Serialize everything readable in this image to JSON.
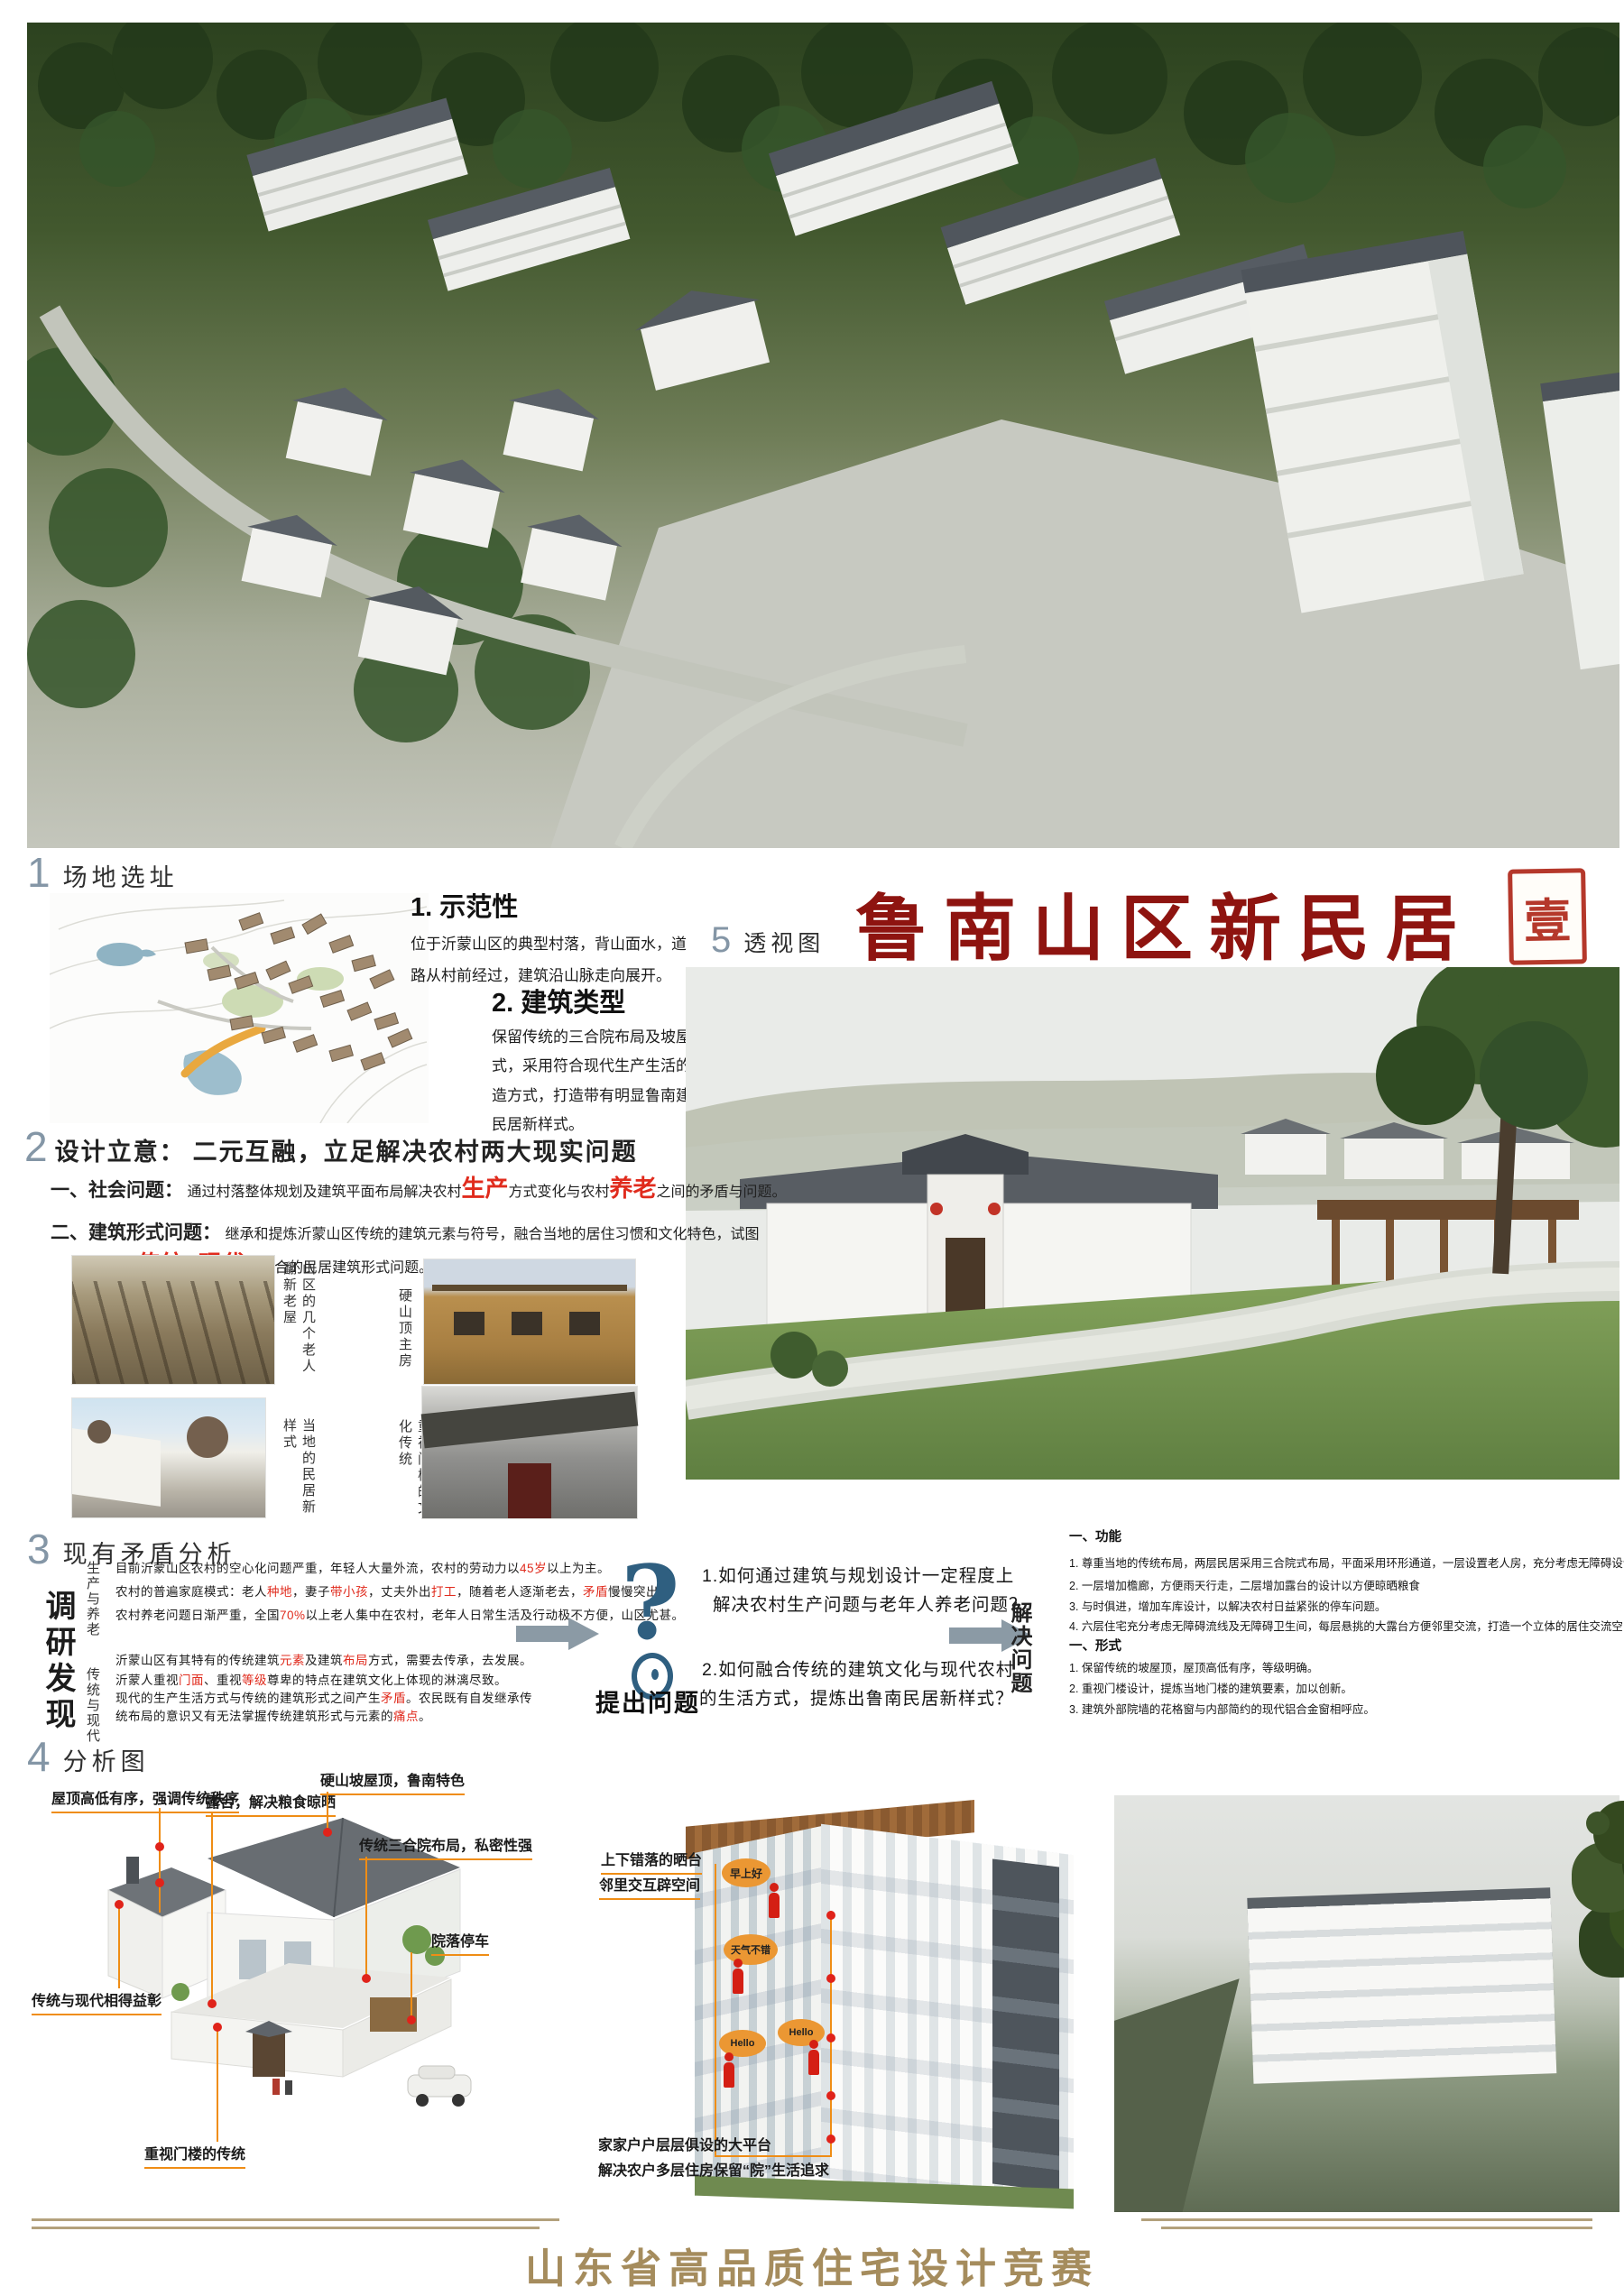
{
  "main_title": {
    "text": "鲁南山区新民居",
    "seal": "壹"
  },
  "footer": {
    "title": "山东省高品质住宅设计竞赛"
  },
  "section1": {
    "num": "1",
    "title": "场地选址",
    "demo": {
      "heading": "1. 示范性",
      "body": "位于沂蒙山区的典型村落，背山面水，道路从村前经过，建筑沿山脉走向展开。"
    },
    "type": {
      "heading": "2. 建筑类型",
      "body": "保留传统的三合院布局及坡屋顶的建筑形式，采用符合现代生产生活的平面及建筑构造方式，打造带有明显鲁南建筑风格特点的民居新样式。"
    }
  },
  "section5": {
    "num": "5",
    "title": "透视图"
  },
  "section2": {
    "num": "2",
    "lead": "设计立意：",
    "headline": "二元互融，立足解决农村两大现实问题",
    "item1_label": "一、社会问题：",
    "item1": [
      {
        "t": "通过村落整体规划及建筑平面布局解决农村"
      },
      {
        "t": "生产",
        "hl": true,
        "big": true
      },
      {
        "t": "方式变化与农村"
      },
      {
        "t": "养老",
        "hl": true,
        "big": true
      },
      {
        "t": "之间的矛盾与问题。"
      }
    ],
    "item2_label": "二、建筑形式问题：",
    "item2a": [
      {
        "t": "继承和提炼沂蒙山区传统的建筑元素与符号，融合当地的居住习惯和文化特色，试图"
      }
    ],
    "item2b": [
      {
        "t": "解决"
      },
      {
        "t": "传统",
        "hl": true,
        "big": true
      },
      {
        "t": "与"
      },
      {
        "t": "现代",
        "hl": true,
        "big": true
      },
      {
        "t": "相结合的民居建筑形式问题。"
      }
    ]
  },
  "photos": {
    "cap1": "山区的几个老人翻新老屋",
    "cap2": "当地的民居新样式",
    "cap3": "硬山顶主房",
    "cap4": "重视门楼的文化传统"
  },
  "section3": {
    "num": "3",
    "title": "现有矛盾分析",
    "survey_label": "调研发现",
    "g1_label": "生产与养老",
    "g1": [
      [
        {
          "t": "目前沂蒙山区农村的空心化问题严重，年轻人大量外流，农村的劳动力以"
        },
        {
          "t": "45岁",
          "hl": true
        },
        {
          "t": "以上为主。"
        }
      ],
      [
        {
          "t": "农村的普遍家庭模式：老人"
        },
        {
          "t": "种地",
          "hl": true
        },
        {
          "t": "，妻子"
        },
        {
          "t": "带小孩",
          "hl": true
        },
        {
          "t": "，丈夫外出"
        },
        {
          "t": "打工",
          "hl": true
        },
        {
          "t": "，随着老人逐渐老去，"
        },
        {
          "t": "矛盾",
          "hl": true
        },
        {
          "t": "慢慢突出。"
        }
      ],
      [
        {
          "t": "农村养老问题日渐严重，全国"
        },
        {
          "t": "70%",
          "hl": true
        },
        {
          "t": "以上老人集中在农村，老年人日常生活及行动极不方便，山区尤甚。"
        }
      ]
    ],
    "g2_label": "传统与现代",
    "g2": [
      [
        {
          "t": "沂蒙山区有其特有的传统建筑"
        },
        {
          "t": "元素",
          "hl": true
        },
        {
          "t": "及建筑"
        },
        {
          "t": "布局",
          "hl": true
        },
        {
          "t": "方式，需要去传承，去发展。"
        }
      ],
      [
        {
          "t": "沂蒙人重视"
        },
        {
          "t": "门面",
          "hl": true
        },
        {
          "t": "、重视"
        },
        {
          "t": "等级",
          "hl": true
        },
        {
          "t": "尊卑的特点在建筑文化上体现的淋漓尽致。"
        }
      ],
      [
        {
          "t": "现代的生产生活方式与传统的建筑形式之间产生"
        },
        {
          "t": "矛盾",
          "hl": true
        },
        {
          "t": "。农民既有自发继承传"
        }
      ],
      [
        {
          "t": "统布局的意识又有无法掌握传统建筑形式与元素的"
        },
        {
          "t": "痛点",
          "hl": true
        },
        {
          "t": "。"
        }
      ]
    ],
    "question_mark": "?",
    "ask_label": "提出问题",
    "q1a": "1.如何通过建筑与规划设计一定程度上",
    "q1b": "解决农村生产问题与老年人养老问题？",
    "q2a": "2.如何融合传统的建筑文化与现代农村",
    "q2b": "的生活方式，提炼出鲁南民居新样式？",
    "solve_label": "解决问题",
    "sol_g1_heading": "一、功能",
    "sol_g1": [
      "1. 尊重当地的传统布局，两层民居采用三合院式布局，平面采用环形通道，一层设置老人房，充分考虑无障碍设计。",
      "2. 一层增加檐廊，方便雨天行走，二层增加露台的设计以方便晾晒粮食",
      "3. 与时俱进，增加车库设计，以解决农村日益紧张的停车问题。",
      "4. 六层住宅充分考虑无障碍流线及无障碍卫生间，每层悬挑的大露台方便邻里交流，打造一个立体的居住交流空间。"
    ],
    "sol_g2_heading": "一、形式",
    "sol_g2": [
      "1. 保留传统的坡屋顶，屋顶高低有序，等级明确。",
      "2. 重视门楼设计，提炼当地门楼的建筑要素，加以创新。",
      "3. 建筑外部院墙的花格窗与内部简约的现代铝合金窗相呼应。"
    ]
  },
  "section4": {
    "num": "4",
    "title": "分析图",
    "axon1": {
      "l1": "屋顶高低有序，强调传统秩序",
      "l2": "露台，解决粮食晾晒",
      "l3": "硬山坡屋顶，鲁南特色",
      "l4": "传统三合院布局，私密性强",
      "l5": "院落停车",
      "l6": "传统与现代相得益彰",
      "l7": "重视门楼的传统"
    },
    "axon2": {
      "t1": "上下错落的晒台",
      "t2": "邻里交互辟空间",
      "bubble1": "早上好",
      "bubble2": "天气不错",
      "bubble3": "Hello",
      "bubble4": "Hello",
      "b1": "家家户户层层俱设的大平台",
      "b2": "解决农户多层住房保留“院”生活追求"
    }
  },
  "colors": {
    "title_red": "#8e1410",
    "seal_red": "#b5382b",
    "highlight_red": "#e02b1d",
    "section_num_gray": "#8496a6",
    "leader_orange": "#ef8d15",
    "arrow_gray": "#8b9aa5",
    "footer_gold": "#a58c5d"
  }
}
